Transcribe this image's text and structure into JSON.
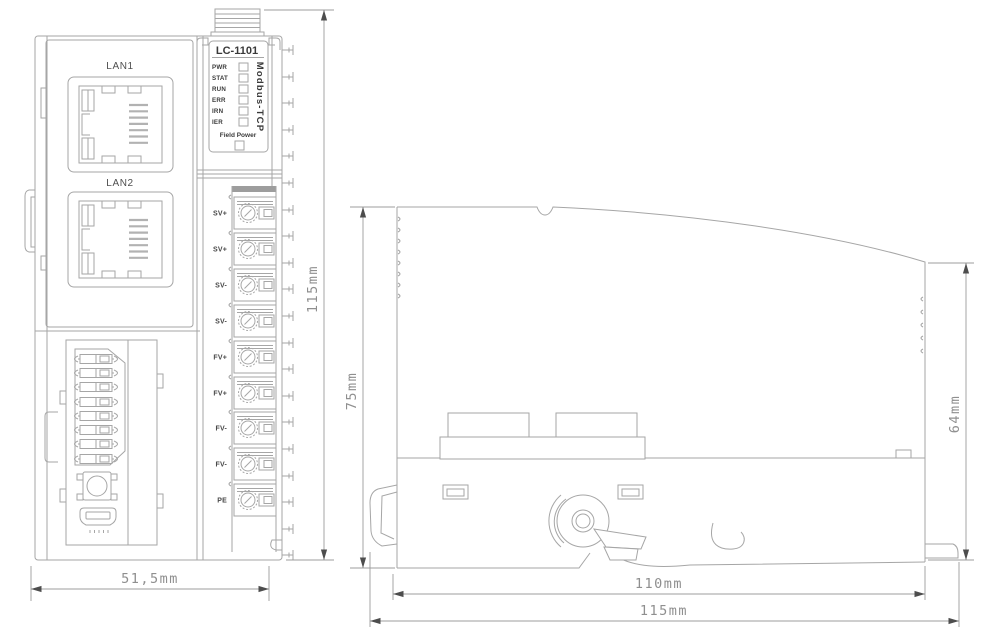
{
  "front_view": {
    "lan_ports": [
      {
        "label": "LAN1"
      },
      {
        "label": "LAN2"
      }
    ],
    "panel": {
      "model": "LC-1101",
      "protocol": "Modbus-TCP",
      "field_power": "Field Power",
      "leds": [
        {
          "label": "PWR"
        },
        {
          "label": "STAT"
        },
        {
          "label": "RUN"
        },
        {
          "label": "ERR"
        },
        {
          "label": "IRN"
        },
        {
          "label": "IER"
        }
      ]
    },
    "terminals": [
      {
        "label": "SV+"
      },
      {
        "label": "SV+"
      },
      {
        "label": "SV-"
      },
      {
        "label": "SV-"
      },
      {
        "label": "FV+"
      },
      {
        "label": "FV+"
      },
      {
        "label": "FV-"
      },
      {
        "label": "FV-"
      },
      {
        "label": "PE"
      }
    ],
    "dimensions": {
      "height": "115mm",
      "width": "51,5mm"
    }
  },
  "side_view": {
    "dimensions": {
      "overall_height": "75mm",
      "body_height": "64mm",
      "rail_width": "110mm",
      "overall_width": "115mm"
    }
  },
  "colors": {
    "line": "#a6a6a6",
    "label_text": "#3a3a3a",
    "dim_text": "#8f8f8f",
    "background": "#ffffff"
  }
}
